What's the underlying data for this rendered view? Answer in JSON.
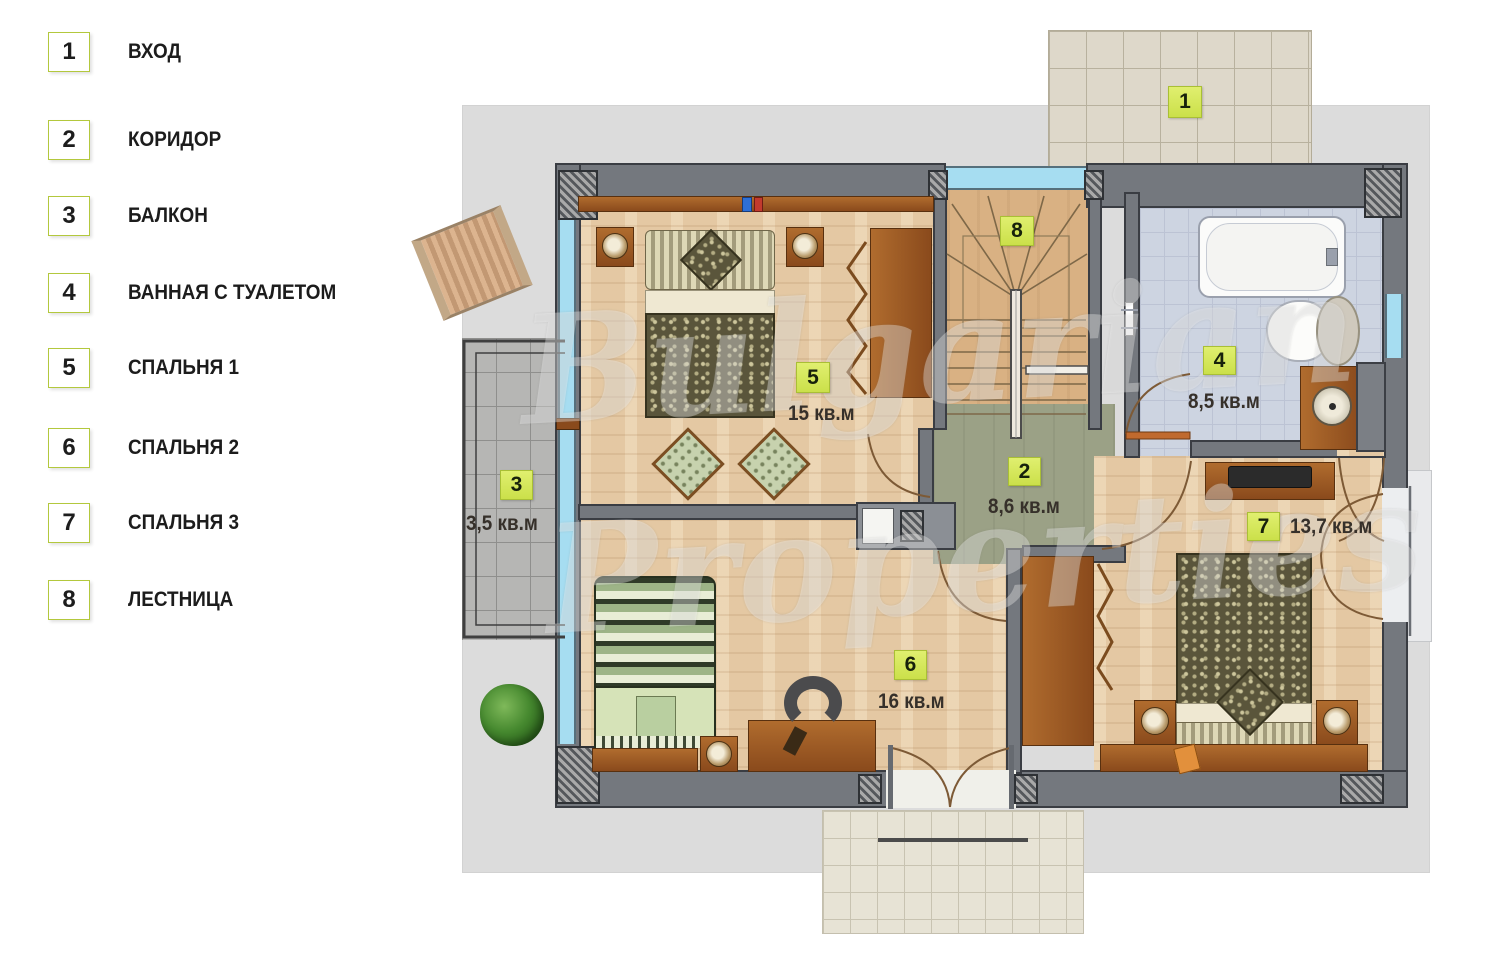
{
  "legend": {
    "items": [
      {
        "num": "1",
        "label": "ВХОД"
      },
      {
        "num": "2",
        "label": "КОРИДОР"
      },
      {
        "num": "3",
        "label": "БАЛКОН"
      },
      {
        "num": "4",
        "label": "ВАННАЯ С ТУАЛЕТОМ"
      },
      {
        "num": "5",
        "label": "СПАЛЬНЯ 1"
      },
      {
        "num": "6",
        "label": "СПАЛЬНЯ 2"
      },
      {
        "num": "7",
        "label": "СПАЛЬНЯ 3"
      },
      {
        "num": "8",
        "label": "ЛЕСТНИЦА"
      }
    ]
  },
  "rooms": {
    "entrance": {
      "num": "1"
    },
    "corridor": {
      "num": "2",
      "area": "8,6 кв.м"
    },
    "balcony": {
      "num": "3",
      "area": "3,5 кв.м"
    },
    "bathroom": {
      "num": "4",
      "area": "8,5 кв.м"
    },
    "bedroom1": {
      "num": "5",
      "area": "15 кв.м"
    },
    "bedroom2": {
      "num": "6",
      "area": "16 кв.м"
    },
    "bedroom3": {
      "num": "7",
      "area": "13,7 кв.м"
    },
    "stairs": {
      "num": "8"
    }
  },
  "watermark": {
    "line1": "Bulgarian",
    "line2": "Properties"
  },
  "colors": {
    "badge": "#d9e868",
    "wall": "#74787e",
    "corridor_floor": "#9ba186",
    "bathroom_floor": "#cdd4e1",
    "wood_floor": "#ead0ab",
    "window": "#a6ddf1"
  }
}
